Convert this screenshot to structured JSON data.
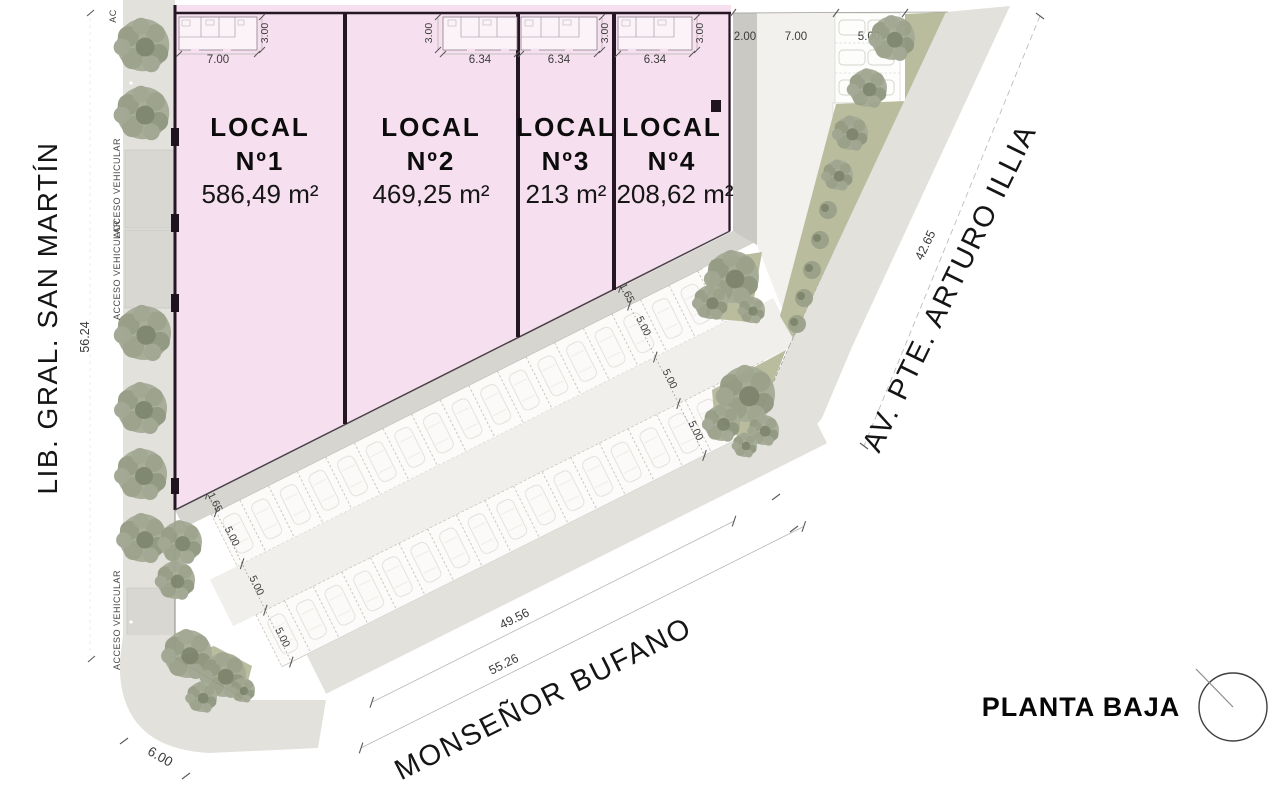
{
  "plan": {
    "title": "PLANTA BAJA",
    "locals": [
      {
        "name": "LOCAL",
        "number": "Nº1",
        "area": "586,49 m²",
        "width_dim": "7.00",
        "depth_dim": "3.00"
      },
      {
        "name": "LOCAL",
        "number": "Nº2",
        "area": "469,25 m²",
        "width_dim": "6.34",
        "depth_dim": "3.00"
      },
      {
        "name": "LOCAL",
        "number": "Nº3",
        "area": "213 m²",
        "width_dim": "6.34",
        "depth_dim": "3.00"
      },
      {
        "name": "LOCAL",
        "number": "Nº4",
        "area": "208,62 m²",
        "width_dim": "6.34",
        "depth_dim": "3.00"
      }
    ],
    "streets": {
      "left": {
        "name": "LIB. GRAL. SAN MARTÍN",
        "frontage_dim": "56.24"
      },
      "bottom": {
        "name": "MONSEÑOR BUFANO",
        "frontage_dim": "49.56",
        "total_dim": "55.26",
        "corner_dim": "6.00"
      },
      "right": {
        "name": "AV. PTE. ARTURO ILLIA",
        "frontage_dim": "42.65"
      }
    },
    "access": {
      "label": "ACCESO VEHICULAR",
      "label_short": "AC"
    },
    "parking": {
      "walkway_dim": "1.65",
      "stall_dim": "5.00",
      "aisle_dim": "5.00",
      "back_stall_dim": "5.00"
    },
    "north_lot": {
      "sidewalk_dim": "2.00",
      "driveway_dim": "7.00",
      "bay_dim": "5.00"
    },
    "colors": {
      "local_fill": "#f6dfee",
      "wall": "#241624",
      "sidewalk": "#e2e1dc",
      "green": "#b9bd9e",
      "tree": "#a6ab97"
    }
  }
}
